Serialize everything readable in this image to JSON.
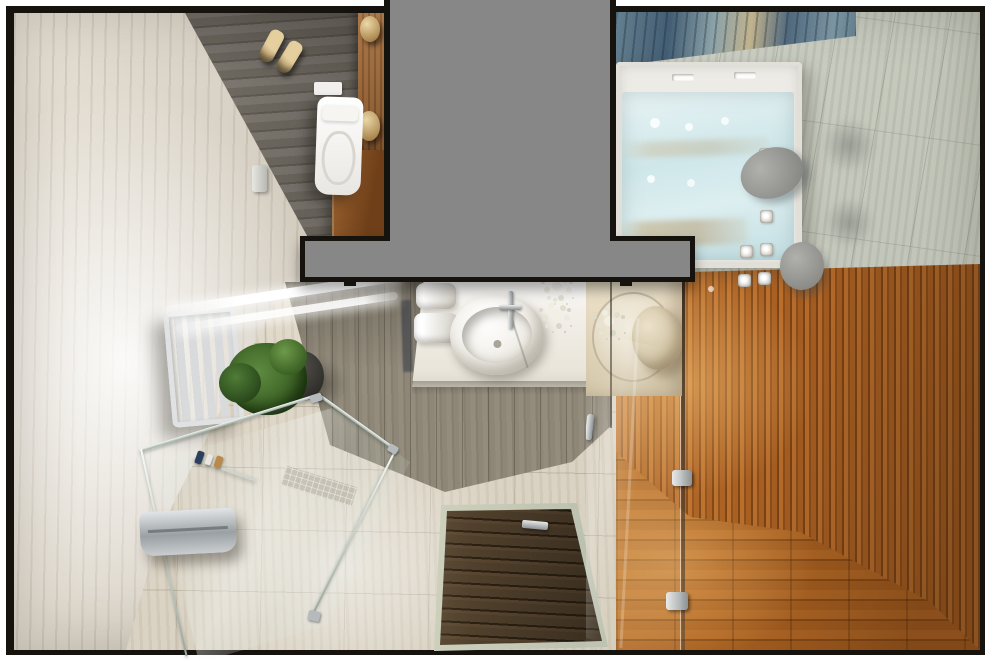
{
  "scene": {
    "description": "Photorealistic 3D top-down render of a modern bathroom floor plan with shower, vanity, toilet room, whirlpool bathtub and wooden sauna area",
    "rooms": [
      "toilet-room",
      "shower-and-vanity-room",
      "bathtub-room",
      "sauna-wood-area"
    ],
    "objects": [
      "wall-hung-toilet",
      "flush-plate",
      "pair-of-slippers",
      "toilet-paper-holder",
      "wood-cabinet",
      "ceramic-jars",
      "towel-radiator",
      "potted-plant",
      "glass-shower-enclosure",
      "shower-bench",
      "shower-shelf-with-toiletries",
      "mosaic-drain-strip",
      "recessed-wood-drain-mat",
      "mat-handle",
      "vanity-counter",
      "oval-vessel-sink",
      "chrome-faucet",
      "rolled-towels",
      "white-flower-arrangements",
      "ceiling-light-strips",
      "whirlpool-bathtub",
      "bath-headrest-pillows",
      "water-jets",
      "blue-marble-wall-panel",
      "glass-partition",
      "door-hinges",
      "door-handle",
      "wooden-stool",
      "wood-slat-wall",
      "wood-plank-floor",
      "gray-wall-cut-mask"
    ]
  },
  "palette": {
    "margin_white": "#ffffff",
    "wall_black": "#16130f",
    "mask_gray": "#878787",
    "marble_light": "#e7e1d6",
    "marble_mid": "#cfc8bb",
    "toilet_floor": "#6f6a61",
    "plank_gray": "#948d7e",
    "tile_beige": "#ddd5c6",
    "wood_cabinet": "#8e5628",
    "wood_slat": "#a85f22",
    "wood_slat_dark": "#7c4315",
    "wood_floor": "#a86020",
    "mat_wood": "#50402c",
    "mat_gap": "#2c2013",
    "tub_white": "#edebe6",
    "water_blue": "#cfe7ea",
    "headrest_gray": "#8d8d8a",
    "marble_blue": "#435d74",
    "marble_tan": "#c0b28d",
    "tile_green": "#c6c9bd",
    "chrome": "#b6babc",
    "fixture_white": "#f1eee7",
    "flower_white": "#f2f0e4",
    "plant_green": "#35591f",
    "pot_dark": "#2e2d29",
    "slipper_tan": "#e5cf9e"
  }
}
